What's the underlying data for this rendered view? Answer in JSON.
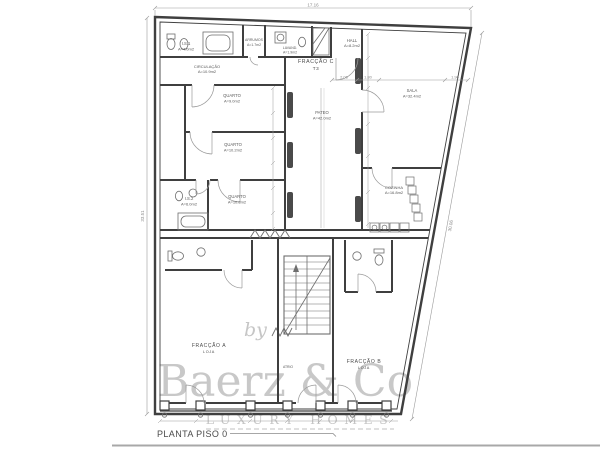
{
  "sheet": {
    "title": "PLANTA PISO 0"
  },
  "watermark": {
    "prefix": "by",
    "brand": "Baerz & Co",
    "tagline": "LUXURY HOMES"
  },
  "dimensions": {
    "top_width": "17.16",
    "left_height": "33.51",
    "right_length": "30.06",
    "chain": [
      "2.06",
      "1.80",
      "1.90"
    ]
  },
  "fractions": {
    "a": {
      "name": "FRACÇÃO A",
      "use": "LOJA"
    },
    "b": {
      "name": "FRACÇÃO B",
      "use": "LOJA"
    },
    "c": {
      "name": "FRACÇÃO C",
      "type": "T3"
    }
  },
  "rooms": {
    "is1": {
      "name": "I.S.1",
      "area": "A=4.0m2"
    },
    "arrumos": {
      "name": "ARRUMOS",
      "area": "A=1.7m2"
    },
    "lavandaria": {
      "name": "LAVAND.",
      "area": "A=1.9m2"
    },
    "hall": {
      "name": "HALL",
      "area": "A=8.2m2"
    },
    "circulacao": {
      "name": "CIRCULAÇÃO",
      "area": "A=10.9m2"
    },
    "quarto1": {
      "name": "QUARTO",
      "area": "A=9.0m2"
    },
    "quarto2": {
      "name": "QUARTO",
      "area": "A=10.2m2"
    },
    "quarto3": {
      "name": "QUARTO",
      "area": "A=10.8m2"
    },
    "is2": {
      "name": "I.S.2",
      "area": "A=6.0m2"
    },
    "pateo": {
      "name": "PATEO",
      "area": "A=42.0m2"
    },
    "sala": {
      "name": "SALA",
      "area": "A=32.4m2"
    },
    "cozinha": {
      "name": "COZINHA",
      "area": "A=16.8m2"
    },
    "atrio": {
      "name": "ATRIO"
    }
  }
}
